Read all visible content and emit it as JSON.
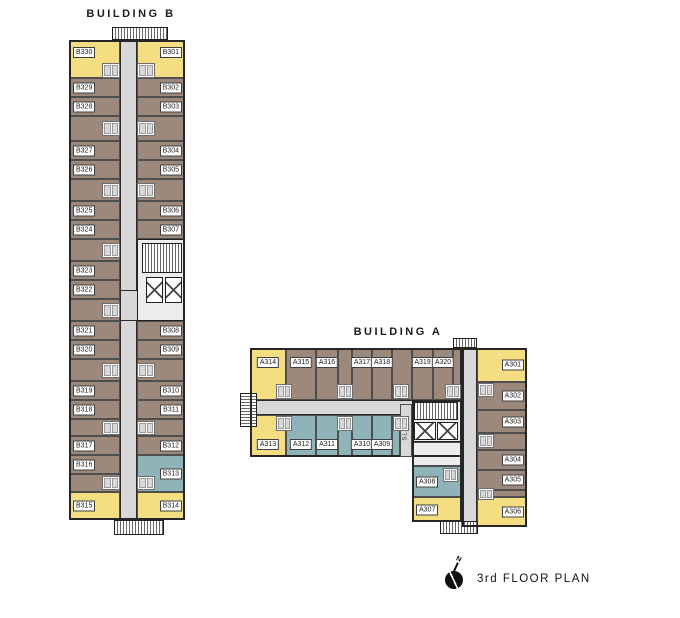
{
  "annotations": {
    "title": "3rd FLOOR PLAN",
    "north_label": "N"
  },
  "colors": {
    "yellow": "#f5dd82",
    "brown": "#9c897b",
    "blue": "#8eb3b9",
    "corridor": "#d8d8d8",
    "core": "#ededed",
    "wall": "#2b2b2b"
  },
  "buildings": [
    {
      "name": "BUILDING B",
      "name_pos": {
        "x": 131,
        "y": 8
      },
      "origin": {
        "x": 69,
        "y": 40,
        "w": 116,
        "h": 480
      },
      "corridors": [
        {
          "x": 51,
          "y": 0,
          "w": 17,
          "h": 480
        },
        {
          "x": 51,
          "y": 250,
          "w": 65,
          "h": 31
        }
      ],
      "outlines": [
        {
          "x": 0,
          "y": 0,
          "w": 116,
          "h": 480
        }
      ],
      "cores": [
        {
          "x": 68,
          "y": 199,
          "w": 48,
          "h": 82
        }
      ],
      "stairs": [
        {
          "x": 73,
          "y": 203,
          "w": 40,
          "h": 30,
          "hatch": "v"
        }
      ],
      "elevators": [
        {
          "x": 77,
          "y": 237,
          "w": 17,
          "h": 26
        },
        {
          "x": 96,
          "y": 237,
          "w": 17,
          "h": 26
        }
      ],
      "bumps": [
        {
          "x": 43,
          "y": -13,
          "w": 56,
          "h": 13,
          "hatch": "v"
        },
        {
          "x": 45,
          "y": 480,
          "w": 50,
          "h": 15,
          "hatch": "v"
        }
      ],
      "fillers": [
        {
          "x": 0,
          "y": 76,
          "w": 51,
          "h": 25,
          "c": "brown"
        },
        {
          "x": 0,
          "y": 139,
          "w": 51,
          "h": 22,
          "c": "brown"
        },
        {
          "x": 0,
          "y": 199,
          "w": 51,
          "h": 22,
          "c": "brown"
        },
        {
          "x": 0,
          "y": 259,
          "w": 51,
          "h": 22,
          "c": "brown"
        },
        {
          "x": 0,
          "y": 319,
          "w": 51,
          "h": 22,
          "c": "brown"
        },
        {
          "x": 0,
          "y": 379,
          "w": 51,
          "h": 17,
          "c": "brown"
        },
        {
          "x": 0,
          "y": 434,
          "w": 51,
          "h": 18,
          "c": "brown"
        },
        {
          "x": 68,
          "y": 76,
          "w": 48,
          "h": 25,
          "c": "brown"
        },
        {
          "x": 68,
          "y": 139,
          "w": 48,
          "h": 22,
          "c": "brown"
        },
        {
          "x": 68,
          "y": 319,
          "w": 48,
          "h": 22,
          "c": "brown"
        },
        {
          "x": 68,
          "y": 379,
          "w": 48,
          "h": 17,
          "c": "brown"
        }
      ],
      "pods": [
        {
          "x": 33,
          "y": 23,
          "w": 18,
          "h": 15
        },
        {
          "x": 33,
          "y": 81,
          "w": 18,
          "h": 15
        },
        {
          "x": 33,
          "y": 143,
          "w": 18,
          "h": 15
        },
        {
          "x": 33,
          "y": 203,
          "w": 18,
          "h": 15
        },
        {
          "x": 33,
          "y": 263,
          "w": 18,
          "h": 15
        },
        {
          "x": 33,
          "y": 323,
          "w": 18,
          "h": 15
        },
        {
          "x": 33,
          "y": 381,
          "w": 18,
          "h": 14
        },
        {
          "x": 33,
          "y": 436,
          "w": 18,
          "h": 14
        },
        {
          "x": 68,
          "y": 23,
          "w": 18,
          "h": 15
        },
        {
          "x": 68,
          "y": 81,
          "w": 18,
          "h": 15
        },
        {
          "x": 68,
          "y": 143,
          "w": 18,
          "h": 15
        },
        {
          "x": 68,
          "y": 323,
          "w": 18,
          "h": 15
        },
        {
          "x": 68,
          "y": 381,
          "w": 18,
          "h": 14
        },
        {
          "x": 68,
          "y": 436,
          "w": 18,
          "h": 14
        }
      ],
      "units": [
        {
          "id": "B330",
          "x": 0,
          "y": 0,
          "w": 51,
          "h": 38,
          "c": "yellow",
          "s": "left-top"
        },
        {
          "id": "B329",
          "x": 0,
          "y": 38,
          "w": 51,
          "h": 19,
          "c": "brown",
          "s": "left"
        },
        {
          "id": "B328",
          "x": 0,
          "y": 57,
          "w": 51,
          "h": 19,
          "c": "brown",
          "s": "left"
        },
        {
          "id": "B327",
          "x": 0,
          "y": 101,
          "w": 51,
          "h": 19,
          "c": "brown",
          "s": "left"
        },
        {
          "id": "B326",
          "x": 0,
          "y": 120,
          "w": 51,
          "h": 19,
          "c": "brown",
          "s": "left"
        },
        {
          "id": "B325",
          "x": 0,
          "y": 161,
          "w": 51,
          "h": 19,
          "c": "brown",
          "s": "left"
        },
        {
          "id": "B324",
          "x": 0,
          "y": 180,
          "w": 51,
          "h": 19,
          "c": "brown",
          "s": "left"
        },
        {
          "id": "B323",
          "x": 0,
          "y": 221,
          "w": 51,
          "h": 19,
          "c": "brown",
          "s": "left"
        },
        {
          "id": "B322",
          "x": 0,
          "y": 240,
          "w": 51,
          "h": 19,
          "c": "brown",
          "s": "left"
        },
        {
          "id": "B321",
          "x": 0,
          "y": 281,
          "w": 51,
          "h": 19,
          "c": "brown",
          "s": "left"
        },
        {
          "id": "B320",
          "x": 0,
          "y": 300,
          "w": 51,
          "h": 19,
          "c": "brown",
          "s": "left"
        },
        {
          "id": "B319",
          "x": 0,
          "y": 341,
          "w": 51,
          "h": 19,
          "c": "brown",
          "s": "left"
        },
        {
          "id": "B318",
          "x": 0,
          "y": 360,
          "w": 51,
          "h": 19,
          "c": "brown",
          "s": "left"
        },
        {
          "id": "B317",
          "x": 0,
          "y": 396,
          "w": 51,
          "h": 19,
          "c": "brown",
          "s": "left"
        },
        {
          "id": "B316",
          "x": 0,
          "y": 415,
          "w": 51,
          "h": 19,
          "c": "brown",
          "s": "left"
        },
        {
          "id": "B315",
          "x": 0,
          "y": 452,
          "w": 51,
          "h": 28,
          "c": "yellow",
          "s": "left"
        },
        {
          "id": "B301",
          "x": 68,
          "y": 0,
          "w": 48,
          "h": 38,
          "c": "yellow",
          "s": "right-top"
        },
        {
          "id": "B302",
          "x": 68,
          "y": 38,
          "w": 48,
          "h": 19,
          "c": "brown",
          "s": "right"
        },
        {
          "id": "B303",
          "x": 68,
          "y": 57,
          "w": 48,
          "h": 19,
          "c": "brown",
          "s": "right"
        },
        {
          "id": "B304",
          "x": 68,
          "y": 101,
          "w": 48,
          "h": 19,
          "c": "brown",
          "s": "right"
        },
        {
          "id": "B305",
          "x": 68,
          "y": 120,
          "w": 48,
          "h": 19,
          "c": "brown",
          "s": "right"
        },
        {
          "id": "B306",
          "x": 68,
          "y": 161,
          "w": 48,
          "h": 19,
          "c": "brown",
          "s": "right"
        },
        {
          "id": "B307",
          "x": 68,
          "y": 180,
          "w": 48,
          "h": 19,
          "c": "brown",
          "s": "right"
        },
        {
          "id": "B308",
          "x": 68,
          "y": 281,
          "w": 48,
          "h": 19,
          "c": "brown",
          "s": "right"
        },
        {
          "id": "B309",
          "x": 68,
          "y": 300,
          "w": 48,
          "h": 19,
          "c": "brown",
          "s": "right"
        },
        {
          "id": "B310",
          "x": 68,
          "y": 341,
          "w": 48,
          "h": 19,
          "c": "brown",
          "s": "right"
        },
        {
          "id": "B311",
          "x": 68,
          "y": 360,
          "w": 48,
          "h": 19,
          "c": "brown",
          "s": "right"
        },
        {
          "id": "B312",
          "x": 68,
          "y": 396,
          "w": 48,
          "h": 19,
          "c": "brown",
          "s": "right"
        },
        {
          "id": "B313",
          "x": 68,
          "y": 415,
          "w": 48,
          "h": 37,
          "c": "blue",
          "s": "right"
        },
        {
          "id": "B314",
          "x": 68,
          "y": 452,
          "w": 48,
          "h": 28,
          "c": "yellow",
          "s": "right"
        }
      ]
    },
    {
      "name": "BUILDING A",
      "name_pos": {
        "x": 398,
        "y": 326
      },
      "origin": {
        "x": 240,
        "y": 345,
        "w": 290,
        "h": 215
      },
      "corridors": [
        {
          "x": 10,
          "y": 55,
          "w": 212,
          "h": 15
        },
        {
          "x": 222,
          "y": 3,
          "w": 15,
          "h": 182
        }
      ],
      "outlines": [
        {
          "x": 10,
          "y": 3,
          "w": 212,
          "h": 109
        },
        {
          "x": 222,
          "y": 3,
          "w": 65,
          "h": 179
        },
        {
          "x": 172,
          "y": 55,
          "w": 50,
          "h": 122
        }
      ],
      "cores": [
        {
          "x": 172,
          "y": 55,
          "w": 50,
          "h": 42
        }
      ],
      "slab": {
        "x": 160,
        "y": 59,
        "w": 12,
        "h": 53,
        "label": "SLAB"
      },
      "stairs": [
        {
          "x": 174,
          "y": 57,
          "w": 44,
          "h": 18,
          "hatch": "v"
        }
      ],
      "elevators": [
        {
          "x": 174,
          "y": 77,
          "w": 22,
          "h": 18
        },
        {
          "x": 197,
          "y": 77,
          "w": 21,
          "h": 18
        }
      ],
      "bumps": [
        {
          "x": 0,
          "y": 48,
          "w": 17,
          "h": 34,
          "hatch": "h"
        },
        {
          "x": 200,
          "y": 176,
          "w": 38,
          "h": 13,
          "hatch": "v"
        },
        {
          "x": 213,
          "y": -7,
          "w": 24,
          "h": 10,
          "hatch": "v"
        }
      ],
      "fillers": [
        {
          "x": 98,
          "y": 3,
          "w": 14,
          "h": 52,
          "c": "brown"
        },
        {
          "x": 152,
          "y": 3,
          "w": 20,
          "h": 52,
          "c": "brown"
        },
        {
          "x": 213,
          "y": 3,
          "w": 9,
          "h": 52,
          "c": "brown"
        },
        {
          "x": 98,
          "y": 70,
          "w": 14,
          "h": 42,
          "c": "blue"
        },
        {
          "x": 152,
          "y": 70,
          "w": 8,
          "h": 42,
          "c": "blue"
        },
        {
          "x": 237,
          "y": 88,
          "w": 50,
          "h": 17,
          "c": "brown"
        },
        {
          "x": 237,
          "y": 145,
          "w": 50,
          "h": 7,
          "c": "brown"
        },
        {
          "x": 172,
          "y": 97,
          "w": 50,
          "h": 24,
          "c": "core"
        }
      ],
      "pods": [
        {
          "x": 36,
          "y": 39,
          "w": 16,
          "h": 15
        },
        {
          "x": 97,
          "y": 39,
          "w": 16,
          "h": 15
        },
        {
          "x": 153,
          "y": 39,
          "w": 16,
          "h": 15
        },
        {
          "x": 205,
          "y": 39,
          "w": 16,
          "h": 15
        },
        {
          "x": 36,
          "y": 71,
          "w": 16,
          "h": 15
        },
        {
          "x": 97,
          "y": 71,
          "w": 16,
          "h": 15
        },
        {
          "x": 153,
          "y": 71,
          "w": 16,
          "h": 15
        },
        {
          "x": 238,
          "y": 38,
          "w": 16,
          "h": 14
        },
        {
          "x": 238,
          "y": 89,
          "w": 16,
          "h": 14
        },
        {
          "x": 238,
          "y": 143,
          "w": 16,
          "h": 12
        },
        {
          "x": 203,
          "y": 123,
          "w": 15,
          "h": 14
        }
      ],
      "units": [
        {
          "id": "A314",
          "x": 10,
          "y": 3,
          "w": 36,
          "h": 52,
          "c": "yellow",
          "s": "top"
        },
        {
          "id": "A315",
          "x": 46,
          "y": 3,
          "w": 30,
          "h": 52,
          "c": "brown",
          "s": "top"
        },
        {
          "id": "A316",
          "x": 76,
          "y": 3,
          "w": 22,
          "h": 52,
          "c": "brown",
          "s": "top"
        },
        {
          "id": "A317",
          "x": 112,
          "y": 3,
          "w": 20,
          "h": 52,
          "c": "brown",
          "s": "top"
        },
        {
          "id": "A318",
          "x": 132,
          "y": 3,
          "w": 20,
          "h": 52,
          "c": "brown",
          "s": "top"
        },
        {
          "id": "A319",
          "x": 172,
          "y": 3,
          "w": 21,
          "h": 52,
          "c": "brown",
          "s": "top"
        },
        {
          "id": "A320",
          "x": 193,
          "y": 3,
          "w": 20,
          "h": 52,
          "c": "brown",
          "s": "top"
        },
        {
          "id": "A313",
          "x": 10,
          "y": 70,
          "w": 36,
          "h": 42,
          "c": "yellow",
          "s": "bottom"
        },
        {
          "id": "A312",
          "x": 46,
          "y": 70,
          "w": 30,
          "h": 42,
          "c": "blue",
          "s": "bottom"
        },
        {
          "id": "A311",
          "x": 76,
          "y": 70,
          "w": 22,
          "h": 42,
          "c": "blue",
          "s": "bottom"
        },
        {
          "id": "A310",
          "x": 112,
          "y": 70,
          "w": 20,
          "h": 42,
          "c": "blue",
          "s": "bottom"
        },
        {
          "id": "A309",
          "x": 132,
          "y": 70,
          "w": 20,
          "h": 42,
          "c": "blue",
          "s": "bottom"
        },
        {
          "id": "A301",
          "x": 237,
          "y": 3,
          "w": 50,
          "h": 34,
          "c": "yellow",
          "s": "right"
        },
        {
          "id": "A302",
          "x": 237,
          "y": 37,
          "w": 50,
          "h": 28,
          "c": "brown",
          "s": "right"
        },
        {
          "id": "A303",
          "x": 237,
          "y": 65,
          "w": 50,
          "h": 23,
          "c": "brown",
          "s": "right"
        },
        {
          "id": "A304",
          "x": 237,
          "y": 105,
          "w": 50,
          "h": 20,
          "c": "brown",
          "s": "right"
        },
        {
          "id": "A305",
          "x": 237,
          "y": 125,
          "w": 50,
          "h": 20,
          "c": "brown",
          "s": "right"
        },
        {
          "id": "A306",
          "x": 237,
          "y": 152,
          "w": 50,
          "h": 30,
          "c": "yellow",
          "s": "right"
        },
        {
          "id": "A308",
          "x": 172,
          "y": 121,
          "w": 50,
          "h": 31,
          "c": "blue",
          "s": "left"
        },
        {
          "id": "A307",
          "x": 172,
          "y": 152,
          "w": 50,
          "h": 25,
          "c": "yellow",
          "s": "left"
        }
      ]
    }
  ]
}
